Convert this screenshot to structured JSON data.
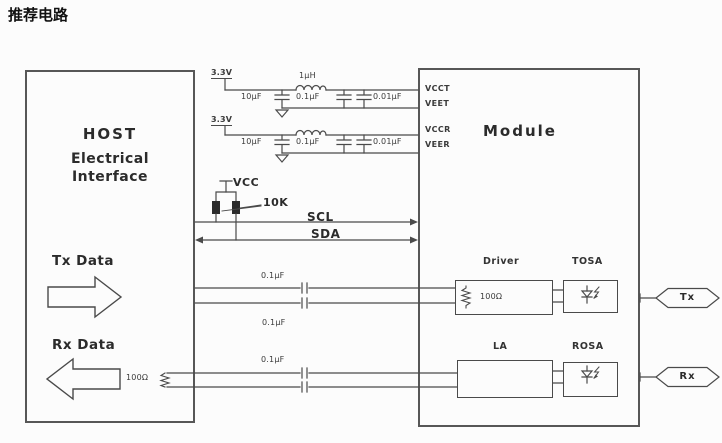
{
  "title": "推荐电路",
  "host": {
    "name": "HOST",
    "line1": "Electrical",
    "line2": "Interface",
    "tx_data": "Tx Data",
    "rx_data": "Rx Data",
    "rx_termination": "100Ω"
  },
  "module": {
    "name": "Module",
    "pin_vcct": "VCCT",
    "pin_veet": "VEET",
    "pin_vccr": "VCCR",
    "pin_veer": "VEER",
    "driver_label": "Driver",
    "driver_resistor": "100Ω",
    "tosa_label": "TOSA",
    "la_label": "LA",
    "rosa_label": "ROSA"
  },
  "filter1": {
    "supply": "3.3V",
    "c1": "10μF",
    "c2": "0.1μF",
    "l1": "1μH",
    "c3": "0.01μF"
  },
  "filter2": {
    "supply": "3.3V",
    "c1": "10μF",
    "c2": "0.1μF",
    "c3": "0.01μF"
  },
  "i2c": {
    "vcc": "VCC",
    "pullups": "10K",
    "scl": "SCL",
    "sda": "SDA"
  },
  "tx_line": {
    "cap_top": "0.1μF",
    "cap_bot": "0.1μF"
  },
  "rx_line": {
    "cap_top": "0.1μF"
  },
  "ports": {
    "tx": "Tx",
    "rx": "Rx"
  },
  "colors": {
    "wire": "#4a4a4a",
    "text": "#2e2e2e",
    "box_border": "#575757",
    "background": "#fcfcfc"
  }
}
